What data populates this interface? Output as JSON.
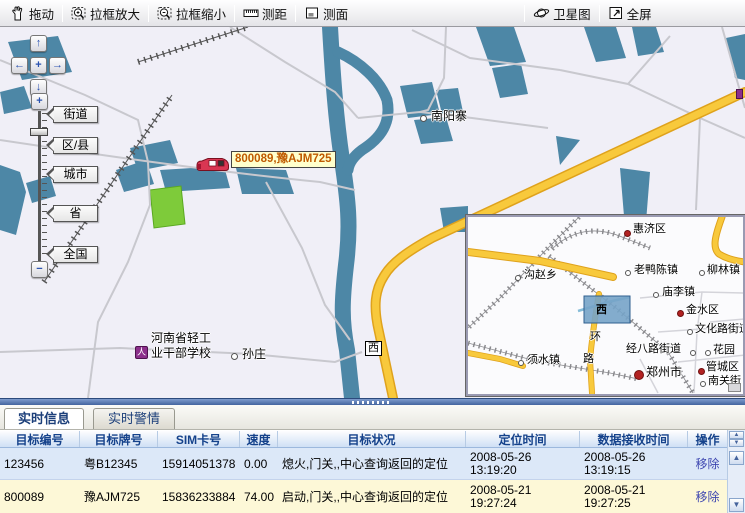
{
  "toolbar": {
    "buttons": [
      {
        "label": "拖动",
        "icon": "hand-icon"
      },
      {
        "label": "拉框放大",
        "icon": "zoom-in-box-icon"
      },
      {
        "label": "拉框缩小",
        "icon": "zoom-out-box-icon"
      },
      {
        "label": "测距",
        "icon": "ruler-icon"
      },
      {
        "label": "测面",
        "icon": "area-icon"
      },
      {
        "label": "卫星图",
        "icon": "satellite-icon"
      },
      {
        "label": "全屏",
        "icon": "fullscreen-icon"
      }
    ]
  },
  "map": {
    "zoom_levels": [
      "街道",
      "区/县",
      "城市",
      "省",
      "全国"
    ],
    "vehicle": {
      "label": "800089,豫AJM725",
      "marker": "car-icon"
    },
    "labels": {
      "town1": "南阳寨",
      "village1": "孙庄",
      "school_line1": "河南省轻工",
      "school_line2": "业干部学校",
      "road_sign": "西"
    }
  },
  "inset": {
    "highlight_label": "西",
    "road_name_chars": [
      "环",
      "路"
    ],
    "places": [
      {
        "name": "惠济区",
        "marker": "red-dot"
      },
      {
        "name": "老鸭陈镇",
        "marker": "circle"
      },
      {
        "name": "柳林镇",
        "marker": "circle"
      },
      {
        "name": "沟赵乡",
        "marker": "circle"
      },
      {
        "name": "庙李镇",
        "marker": "circle"
      },
      {
        "name": "金水区",
        "marker": "red-dot"
      },
      {
        "name": "文化路街道",
        "marker": "circle"
      },
      {
        "name": "经八路街道",
        "marker": "circle"
      },
      {
        "name": "花园",
        "marker": "circle"
      },
      {
        "name": "须水镇",
        "marker": "circle"
      },
      {
        "name": "郑州市",
        "marker": "red-dot-large"
      },
      {
        "name": "管城区",
        "marker": "red-dot"
      },
      {
        "name": "南关街",
        "marker": "circle"
      }
    ]
  },
  "tabs": [
    {
      "label": "实时信息",
      "active": true
    },
    {
      "label": "实时警情",
      "active": false
    }
  ],
  "table": {
    "headers": [
      "目标编号",
      "目标牌号",
      "SIM卡号",
      "速度",
      "目标状况",
      "定位时间",
      "数据接收时间",
      "操作"
    ],
    "rows": [
      {
        "id": "123456",
        "plate": "粤B12345",
        "sim": "15914051378",
        "speed": "0.00",
        "status": "熄火,门关,,中心查询返回的定位",
        "loc_date": "2008-05-26",
        "loc_time": "13:19:20",
        "recv_date": "2008-05-26",
        "recv_time": "13:19:15",
        "action": "移除"
      },
      {
        "id": "800089",
        "plate": "豫AJM725",
        "sim": "15836233884",
        "speed": "74.00",
        "status": "启动,门关,,中心查询返回的定位",
        "loc_date": "2008-05-21",
        "loc_time": "19:27:24",
        "recv_date": "2008-05-21",
        "recv_time": "19:27:25",
        "action": "移除"
      }
    ]
  },
  "colors": {
    "water": "#4d87a6",
    "road_major": "#f8c93c",
    "green_area": "#7ecb3a",
    "selected_row": "#dce8f8",
    "alt_row": "#fdf8d7",
    "header_text": "#15428b",
    "action_link": "#3d46b0",
    "vehicle_label_bg": "#ffffcc",
    "vehicle_label_text": "#c05a00",
    "highlight_box": "#76a3c8"
  }
}
